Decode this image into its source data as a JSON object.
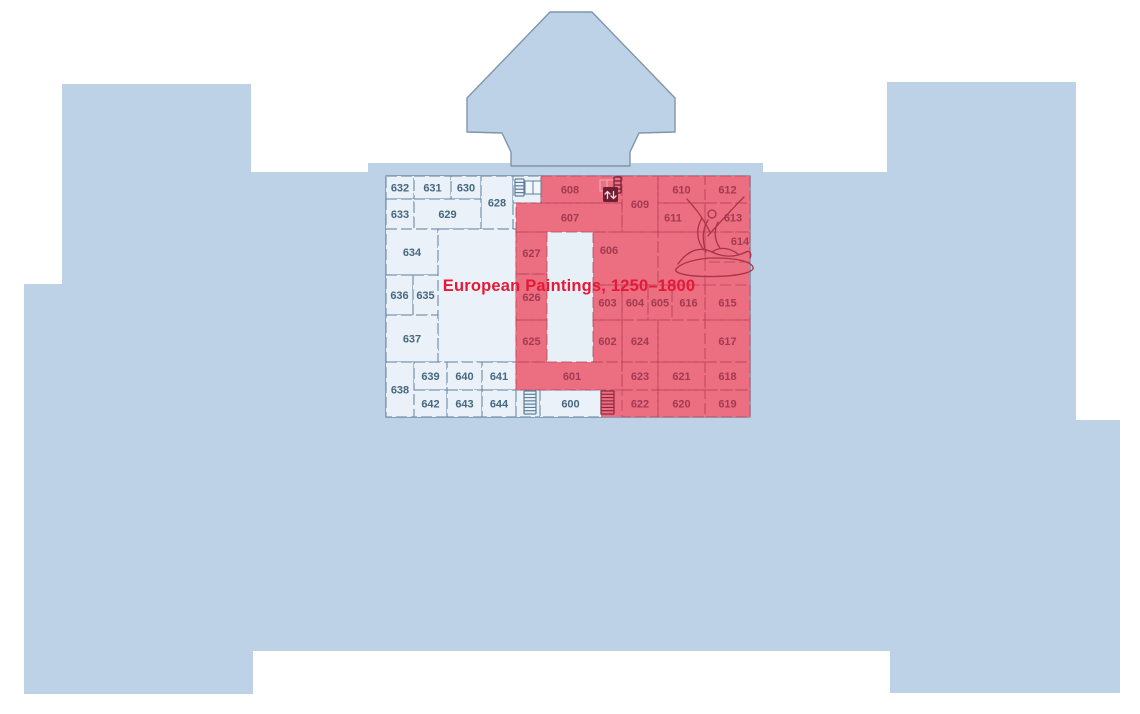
{
  "map": {
    "name": "museum-second-floor-plan",
    "highlight": {
      "title": "European Paintings, 1250–1800",
      "color": "#ec6e81",
      "title_color": "#e51937"
    },
    "colors": {
      "building": "#bdd2e6",
      "room_fill": "#eaf1f8",
      "wall": "#5d7e9c",
      "highlight_fill": "#ec6e81",
      "highlight_wall": "#b5415a",
      "highlight_label": "#a23a51",
      "room_label": "#46687f",
      "icon_dark": "#6f1d31"
    },
    "rooms": [
      {
        "label": "632",
        "x": 386,
        "y": 176,
        "w": 28,
        "h": 23,
        "highlighted": false
      },
      {
        "label": "631",
        "x": 414,
        "y": 176,
        "w": 37,
        "h": 23,
        "highlighted": false
      },
      {
        "label": "630",
        "x": 451,
        "y": 176,
        "w": 30,
        "h": 23,
        "highlighted": false
      },
      {
        "label": "628",
        "x": 481,
        "y": 176,
        "w": 32,
        "h": 53,
        "highlighted": false
      },
      {
        "label": "",
        "x": 513,
        "y": 176,
        "w": 28,
        "h": 27,
        "highlighted": false
      },
      {
        "label": "633",
        "x": 386,
        "y": 199,
        "w": 28,
        "h": 30,
        "highlighted": false
      },
      {
        "label": "629",
        "x": 414,
        "y": 199,
        "w": 67,
        "h": 30,
        "highlighted": false
      },
      {
        "label": "634",
        "x": 386,
        "y": 229,
        "w": 52,
        "h": 46,
        "highlighted": false
      },
      {
        "label": "",
        "x": 438,
        "y": 229,
        "w": 78,
        "h": 133,
        "highlighted": false
      },
      {
        "label": "636",
        "x": 386,
        "y": 275,
        "w": 27,
        "h": 40,
        "highlighted": false
      },
      {
        "label": "635",
        "x": 413,
        "y": 275,
        "w": 25,
        "h": 40,
        "highlighted": false
      },
      {
        "label": "637",
        "x": 386,
        "y": 315,
        "w": 52,
        "h": 47,
        "highlighted": false
      },
      {
        "label": "638",
        "x": 386,
        "y": 362,
        "w": 28,
        "h": 55,
        "highlighted": false
      },
      {
        "label": "639",
        "x": 414,
        "y": 362,
        "w": 33,
        "h": 28,
        "highlighted": false
      },
      {
        "label": "640",
        "x": 447,
        "y": 362,
        "w": 35,
        "h": 28,
        "highlighted": false
      },
      {
        "label": "641",
        "x": 482,
        "y": 362,
        "w": 34,
        "h": 28,
        "highlighted": false
      },
      {
        "label": "642",
        "x": 414,
        "y": 390,
        "w": 33,
        "h": 27,
        "highlighted": false
      },
      {
        "label": "643",
        "x": 447,
        "y": 390,
        "w": 35,
        "h": 27,
        "highlighted": false
      },
      {
        "label": "644",
        "x": 482,
        "y": 390,
        "w": 34,
        "h": 27,
        "highlighted": false
      },
      {
        "label": "",
        "x": 516,
        "y": 390,
        "w": 24,
        "h": 27,
        "highlighted": false
      },
      {
        "label": "600",
        "x": 540,
        "y": 390,
        "w": 61,
        "h": 27,
        "highlighted": false
      },
      {
        "label": "608",
        "x": 541,
        "y": 176,
        "w": 81,
        "h": 27,
        "lx": 570,
        "highlighted": true
      },
      {
        "label": "609",
        "x": 622,
        "y": 176,
        "w": 36,
        "h": 56,
        "highlighted": true
      },
      {
        "label": "610",
        "x": 658,
        "y": 176,
        "w": 47,
        "h": 27,
        "highlighted": true
      },
      {
        "label": "612",
        "x": 705,
        "y": 176,
        "w": 45,
        "h": 27,
        "highlighted": true
      },
      {
        "label": "607",
        "x": 516,
        "y": 203,
        "w": 106,
        "h": 29,
        "lx": 570,
        "highlighted": true
      },
      {
        "label": "611",
        "x": 658,
        "y": 203,
        "w": 47,
        "h": 29,
        "lx": 673,
        "highlighted": true
      },
      {
        "label": "613",
        "x": 705,
        "y": 203,
        "w": 45,
        "h": 29,
        "lx": 733,
        "highlighted": true
      },
      {
        "label": "614",
        "x": 705,
        "y": 232,
        "w": 45,
        "h": 30,
        "lx": 740,
        "ly": 241,
        "highlighted": true
      },
      {
        "label": "627",
        "x": 516,
        "y": 232,
        "w": 31,
        "h": 42,
        "highlighted": true
      },
      {
        "label": "606",
        "x": 593,
        "y": 232,
        "w": 65,
        "h": 53,
        "lx": 609,
        "ly": 250,
        "highlighted": true
      },
      {
        "label": "",
        "x": 658,
        "y": 232,
        "w": 47,
        "h": 53,
        "highlighted": true
      },
      {
        "label": "626",
        "x": 516,
        "y": 274,
        "w": 31,
        "h": 46,
        "highlighted": true
      },
      {
        "label": "603",
        "x": 593,
        "y": 285,
        "w": 29,
        "h": 35,
        "highlighted": true
      },
      {
        "label": "604",
        "x": 622,
        "y": 285,
        "w": 26,
        "h": 35,
        "highlighted": true
      },
      {
        "label": "605",
        "x": 648,
        "y": 285,
        "w": 24,
        "h": 35,
        "highlighted": true
      },
      {
        "label": "616",
        "x": 672,
        "y": 285,
        "w": 33,
        "h": 35,
        "highlighted": true
      },
      {
        "label": "615",
        "x": 705,
        "y": 285,
        "w": 45,
        "h": 35,
        "highlighted": true
      },
      {
        "label": "625",
        "x": 516,
        "y": 320,
        "w": 31,
        "h": 42,
        "highlighted": true
      },
      {
        "label": "602",
        "x": 593,
        "y": 320,
        "w": 29,
        "h": 42,
        "highlighted": true
      },
      {
        "label": "624",
        "x": 622,
        "y": 320,
        "w": 36,
        "h": 42,
        "highlighted": true
      },
      {
        "label": "",
        "x": 658,
        "y": 320,
        "w": 47,
        "h": 42,
        "highlighted": true
      },
      {
        "label": "617",
        "x": 705,
        "y": 320,
        "w": 45,
        "h": 42,
        "highlighted": true
      },
      {
        "label": "601",
        "x": 516,
        "y": 362,
        "w": 106,
        "h": 28,
        "lx": 572,
        "highlighted": true
      },
      {
        "label": "623",
        "x": 622,
        "y": 362,
        "w": 36,
        "h": 28,
        "highlighted": true
      },
      {
        "label": "621",
        "x": 658,
        "y": 362,
        "w": 47,
        "h": 28,
        "highlighted": true
      },
      {
        "label": "618",
        "x": 705,
        "y": 362,
        "w": 45,
        "h": 28,
        "highlighted": true
      },
      {
        "label": "622",
        "x": 622,
        "y": 390,
        "w": 36,
        "h": 27,
        "highlighted": true
      },
      {
        "label": "620",
        "x": 658,
        "y": 390,
        "w": 47,
        "h": 27,
        "highlighted": true
      },
      {
        "label": "619",
        "x": 705,
        "y": 390,
        "w": 45,
        "h": 27,
        "highlighted": true
      }
    ],
    "icons": [
      {
        "name": "stairs-north-icon",
        "type": "stairs-landing",
        "x": 515,
        "y": 179
      },
      {
        "name": "elevator-icon",
        "type": "elevator",
        "x": 599,
        "y": 177
      },
      {
        "name": "stairs-south-west-icon",
        "type": "stairs",
        "x": 524,
        "y": 391
      },
      {
        "name": "stairs-south-east-icon",
        "type": "stairs-dark",
        "x": 601,
        "y": 391
      }
    ],
    "illustration": "reclining-statue-line-art"
  }
}
